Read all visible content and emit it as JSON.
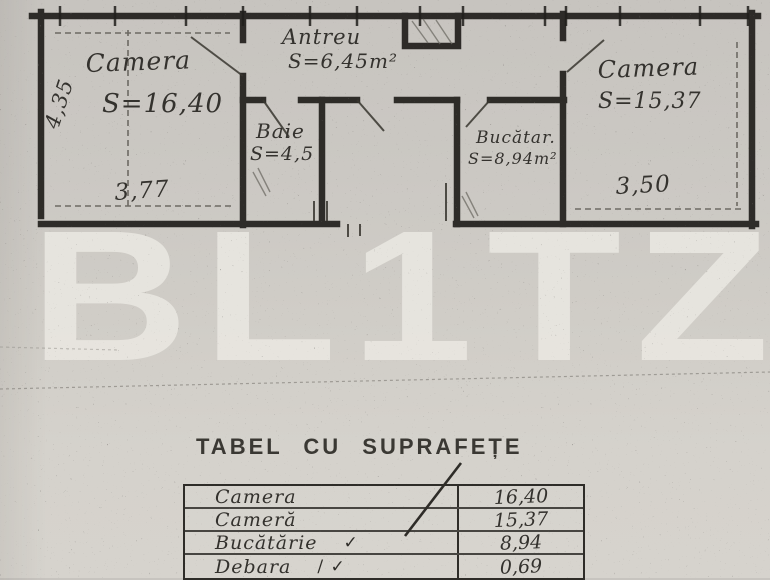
{
  "colors": {
    "ink": "#34322e",
    "wall": "#211f1c",
    "watermark": "#eceae4",
    "paper": "#cdcac5"
  },
  "watermark": {
    "text": "BL1TZ"
  },
  "plan": {
    "rooms": {
      "camera1": {
        "name": "Camera",
        "area": "S=16,40"
      },
      "antreu": {
        "name": "Antreu",
        "area": "S=6,45m²"
      },
      "baie": {
        "name": "Baie",
        "area": "S=4,5"
      },
      "bucatarie": {
        "name": "Bucătar.",
        "area": "S=8,94m²"
      },
      "camera2": {
        "name": "Camera",
        "area": "S=15,37"
      }
    },
    "dimensions": {
      "camera1_height": "4,35",
      "camera1_width": "3,77",
      "camera2_width": "3,50"
    }
  },
  "table": {
    "title": "TABEL CU SUPRAFEȚE",
    "rows": [
      {
        "name": "Camera",
        "check": "",
        "value": "16,40"
      },
      {
        "name": "Cameră",
        "check": "",
        "value": "15,37"
      },
      {
        "name": "Bucătărie",
        "check": "✓",
        "value": "8,94"
      },
      {
        "name": "Debara",
        "check": "/ ✓",
        "value": "0,69"
      }
    ]
  }
}
